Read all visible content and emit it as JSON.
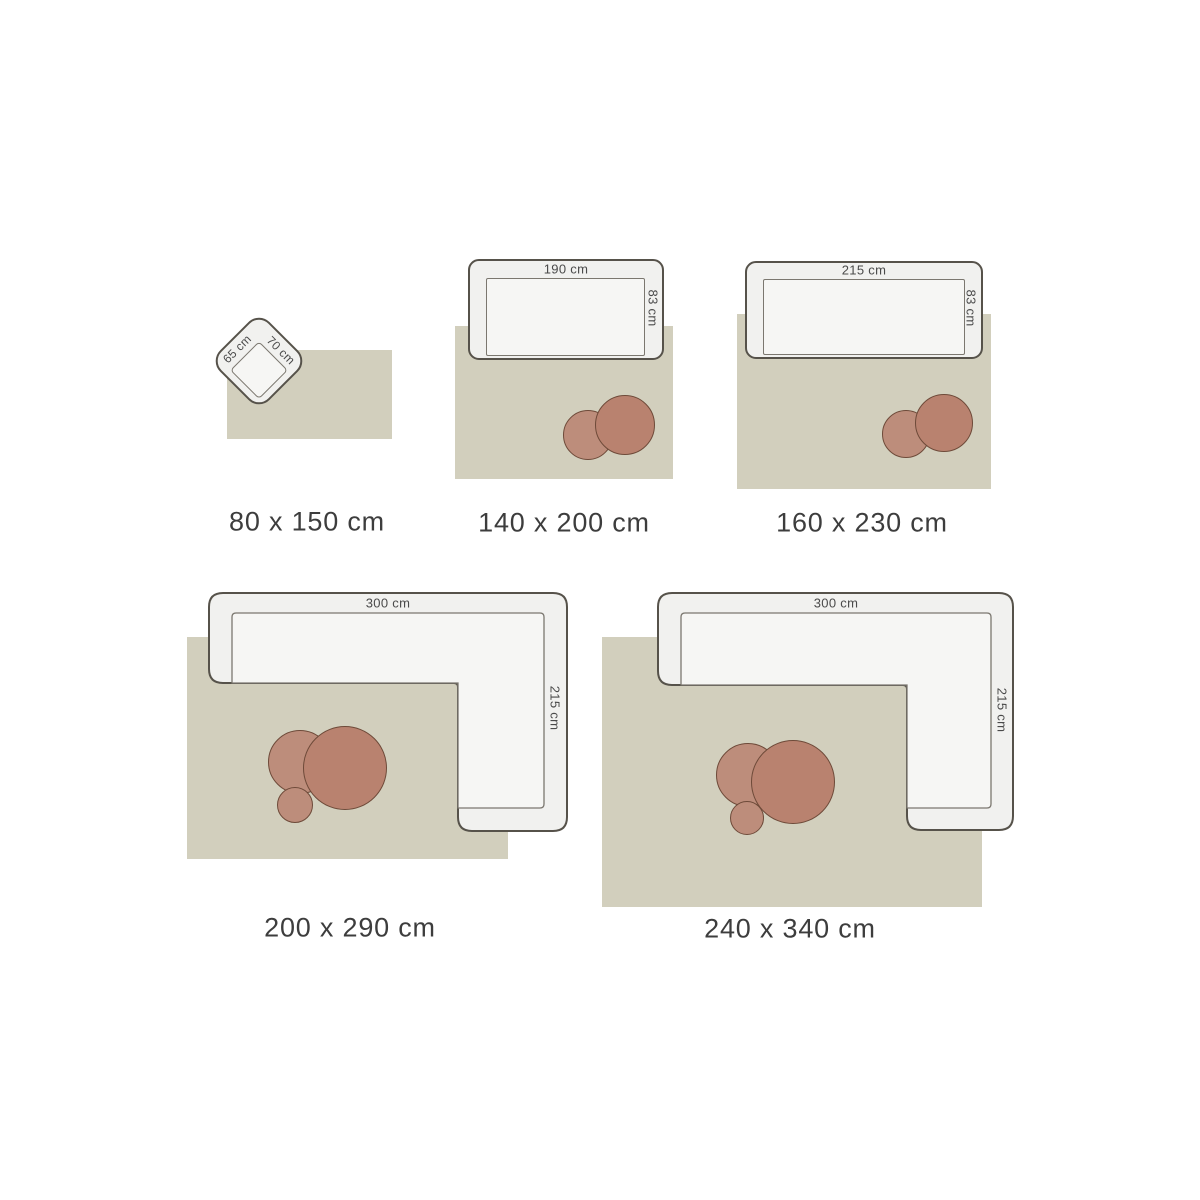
{
  "colors": {
    "background": "#ffffff",
    "rug": "#d2cfbd",
    "furniture_fill": "#f1f1ef",
    "furniture_seat_fill": "#f6f6f4",
    "furniture_outline": "#56524a",
    "seat_outline": "#7b776f",
    "coffee_table_large": "#b9826f",
    "coffee_table_small": "#bd8d7b",
    "coffee_table_outline": "#6e4a39",
    "size_label_text": "#3d3d3d",
    "dimension_label_text": "#4a4a4a"
  },
  "diagrams": [
    {
      "size_label": "80 x 150 cm",
      "furniture_type": "armchair",
      "furniture_width_label": "65 cm",
      "furniture_depth_label": "70 cm"
    },
    {
      "size_label": "140 x 200 cm",
      "furniture_type": "sofa",
      "furniture_width_label": "190 cm",
      "furniture_depth_label": "83 cm"
    },
    {
      "size_label": "160 x 230 cm",
      "furniture_type": "sofa",
      "furniture_width_label": "215 cm",
      "furniture_depth_label": "83 cm"
    },
    {
      "size_label": "200 x 290 cm",
      "furniture_type": "corner-sofa",
      "furniture_width_label": "300 cm",
      "furniture_depth_label": "215 cm"
    },
    {
      "size_label": "240 x 340 cm",
      "furniture_type": "corner-sofa",
      "furniture_width_label": "300 cm",
      "furniture_depth_label": "215 cm"
    }
  ]
}
